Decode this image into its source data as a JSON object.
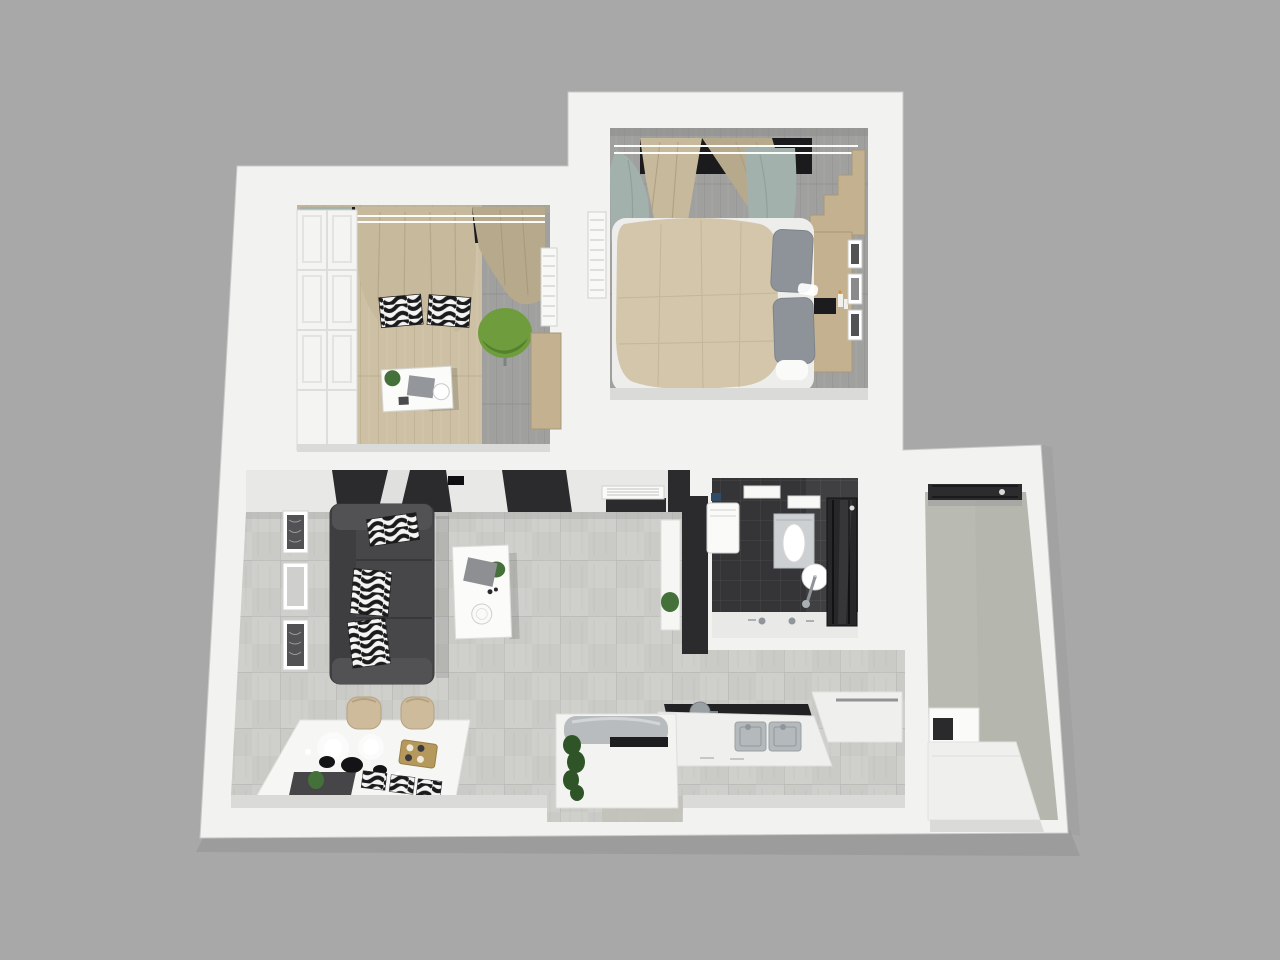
{
  "colors": {
    "background": "#a8a8a8",
    "building_shadow": "#8f8f8f",
    "wall": "#f2f2f1",
    "wall_shade": "#d8d8d6",
    "wall_inner": "#dadad8",
    "tile_floor": "#cfcfcc",
    "tile_line": "#bcbcb9",
    "wood_floor": "#cdc0a4",
    "wood_line": "#b7a88a",
    "gray_wood": "#a0a09f",
    "gray_wood_line": "#909090",
    "bath_floor": "#353537",
    "bath_line": "#48484a",
    "right_floor": "#b5b7ae",
    "sofa": "#47474a",
    "sofa_light": "#525255",
    "sofa_back": "#3e3e41",
    "zebra_white": "#f4f4f2",
    "zebra_black": "#1b1b1d",
    "bed_duvet": "#d3c6aa",
    "bed_line": "#bfb194",
    "pillow": "#8e939a",
    "sheet": "#ededeb",
    "wood_furniture": "#c4b190",
    "wood_edge": "#a9997a",
    "curtain_teal": "#a3b1ad",
    "curtain_beige": "#c7b99c",
    "curtain_beige_dark": "#b7a98c",
    "green_chair": "#6f9d3e",
    "green_chair_dark": "#55802c",
    "charcoal": "#2b2b2e",
    "window_frame": "#1b1b1e",
    "white_furniture": "#f9f9f8",
    "counter_white": "#efefee",
    "steel": "#b4b9bc",
    "steel_dark": "#8f969b",
    "plant": "#44703a",
    "plant_dark": "#2f5428",
    "gold_tray": "#b4985c",
    "glow": "#ffffff",
    "frame_art_dark": "#525254",
    "frame_art_light": "#cfcfcd",
    "toilet_base": "#ccd0d2",
    "appliance_dark": "#2a2a2c"
  }
}
